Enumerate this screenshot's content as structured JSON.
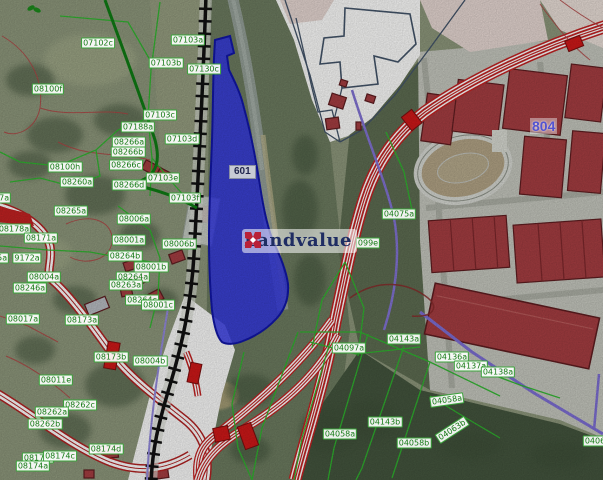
{
  "map": {
    "watermark": {
      "text": "Landvalue",
      "logo": "x-cross-icon"
    },
    "highlighted_parcel": {
      "id": "601"
    },
    "zone_label": {
      "id": "804"
    },
    "colors": {
      "highlight_blue": "#3136e6",
      "highlight_blue_border": "#1217a8",
      "road_red": "#c32222",
      "building_red": "#a63e42",
      "cadastral_green": "#2eb82e",
      "label_green_text": "#157a15",
      "boundary_purple": "#8374d6",
      "railway_black": "#111111",
      "zone_label_blue": "#5353d0",
      "watermark_navy": "#1f2d63",
      "watermark_red": "#b92038"
    },
    "parcel_labels": [
      {
        "text": "07102c",
        "x": 98,
        "y": 43
      },
      {
        "text": "08100f",
        "x": 48,
        "y": 89
      },
      {
        "text": "07103a",
        "x": 188,
        "y": 40
      },
      {
        "text": "07103b",
        "x": 166,
        "y": 63
      },
      {
        "text": "07130c",
        "x": 204,
        "y": 69
      },
      {
        "text": "07103c",
        "x": 160,
        "y": 115
      },
      {
        "text": "07188a",
        "x": 138,
        "y": 127
      },
      {
        "text": "08266a",
        "x": 129,
        "y": 142
      },
      {
        "text": "08266b",
        "x": 128,
        "y": 152
      },
      {
        "text": "07103d",
        "x": 182,
        "y": 139
      },
      {
        "text": "08100h",
        "x": 65,
        "y": 167
      },
      {
        "text": "08266c",
        "x": 126,
        "y": 165
      },
      {
        "text": "08260a",
        "x": 77,
        "y": 182
      },
      {
        "text": "07103e",
        "x": 163,
        "y": 178
      },
      {
        "text": "08266d",
        "x": 129,
        "y": 185
      },
      {
        "text": "07103f",
        "x": 185,
        "y": 198
      },
      {
        "text": "08207a",
        "x": -6,
        "y": 198
      },
      {
        "text": "08265a",
        "x": 71,
        "y": 211
      },
      {
        "text": "08006a",
        "x": 134,
        "y": 219
      },
      {
        "text": "08178a",
        "x": 14,
        "y": 229
      },
      {
        "text": "08171a",
        "x": 41,
        "y": 238
      },
      {
        "text": "08001a",
        "x": 129,
        "y": 240
      },
      {
        "text": "08006b",
        "x": 179,
        "y": 244
      },
      {
        "text": "08005a",
        "x": -8,
        "y": 258
      },
      {
        "text": "9172a",
        "x": 27,
        "y": 258
      },
      {
        "text": "08264b",
        "x": 125,
        "y": 256
      },
      {
        "text": "08001b",
        "x": 151,
        "y": 267
      },
      {
        "text": "08264a",
        "x": 133,
        "y": 277
      },
      {
        "text": "08004a",
        "x": 44,
        "y": 277
      },
      {
        "text": "08263a",
        "x": 126,
        "y": 285
      },
      {
        "text": "08246a",
        "x": 30,
        "y": 288
      },
      {
        "text": "08264c",
        "x": 142,
        "y": 300
      },
      {
        "text": "08001c",
        "x": 158,
        "y": 305
      },
      {
        "text": "08017a",
        "x": 23,
        "y": 319
      },
      {
        "text": "08173a",
        "x": 82,
        "y": 320
      },
      {
        "text": "08173b",
        "x": 111,
        "y": 357
      },
      {
        "text": "08004b",
        "x": 150,
        "y": 361
      },
      {
        "text": "08011e",
        "x": 56,
        "y": 380
      },
      {
        "text": "08262c",
        "x": 80,
        "y": 405
      },
      {
        "text": "08262a",
        "x": 52,
        "y": 412
      },
      {
        "text": "08262b",
        "x": 45,
        "y": 424
      },
      {
        "text": "08174d",
        "x": 106,
        "y": 449
      },
      {
        "text": "08174f",
        "x": 38,
        "y": 458
      },
      {
        "text": "08174c",
        "x": 60,
        "y": 456
      },
      {
        "text": "08174a",
        "x": 33,
        "y": 466
      },
      {
        "text": "04075a",
        "x": 399,
        "y": 214
      },
      {
        "text": "099e",
        "x": 368,
        "y": 243
      },
      {
        "text": "04097a",
        "x": 349,
        "y": 348
      },
      {
        "text": "04143a",
        "x": 404,
        "y": 339
      },
      {
        "text": "04136a",
        "x": 452,
        "y": 357
      },
      {
        "text": "04137a",
        "x": 471,
        "y": 366
      },
      {
        "text": "04138a",
        "x": 498,
        "y": 372
      },
      {
        "text": "04058a",
        "x": 447,
        "y": 400,
        "rot": -8
      },
      {
        "text": "04063b",
        "x": 452,
        "y": 430,
        "rot": -33
      },
      {
        "text": "04058a",
        "x": 340,
        "y": 434
      },
      {
        "text": "04143b",
        "x": 385,
        "y": 422
      },
      {
        "text": "04058b",
        "x": 414,
        "y": 443
      },
      {
        "text": "04063a",
        "x": 600,
        "y": 441
      }
    ]
  }
}
